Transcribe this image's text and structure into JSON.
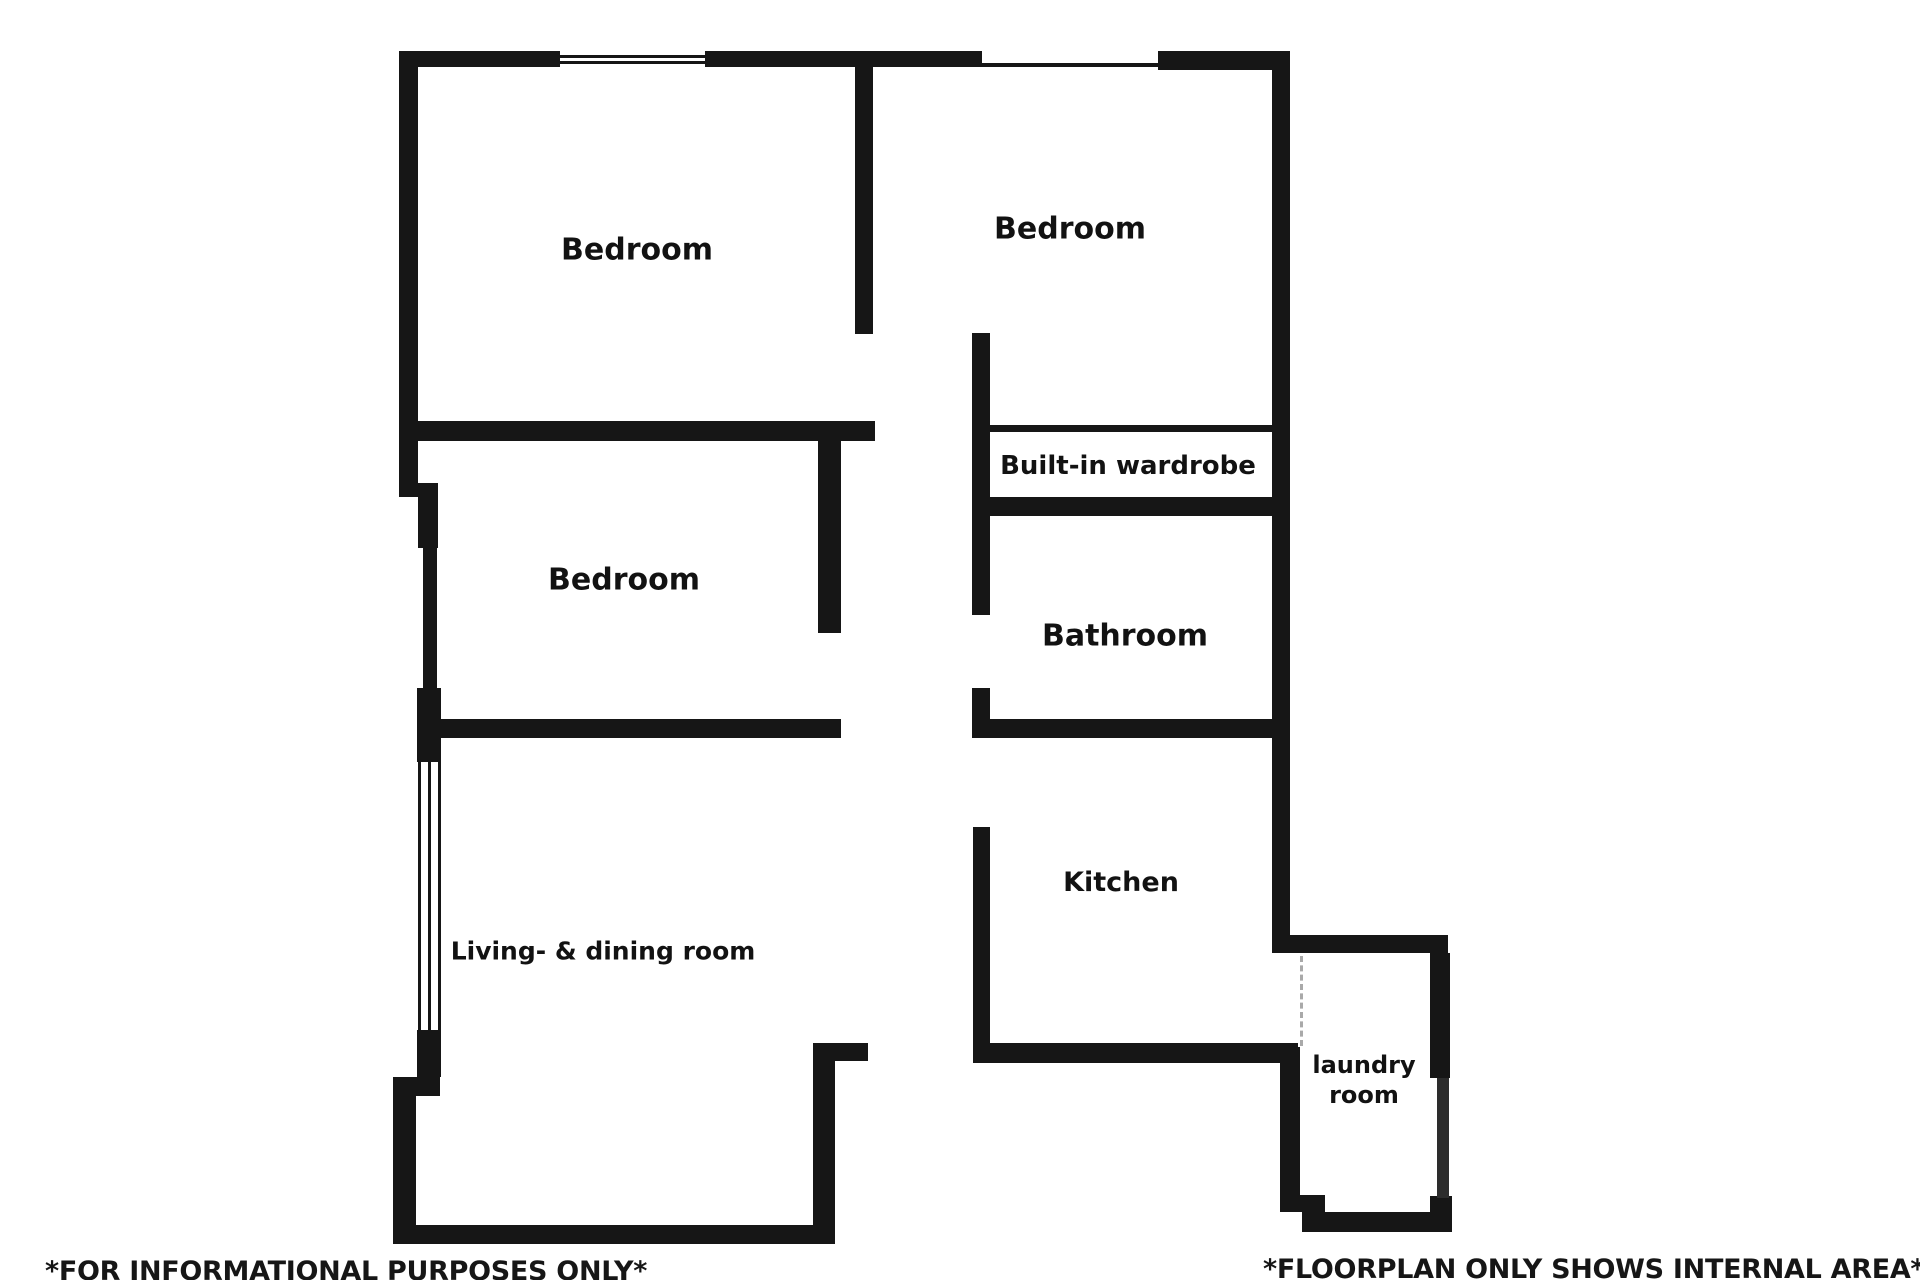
{
  "page": {
    "width": 1920,
    "height": 1280,
    "background": "#ffffff"
  },
  "colors": {
    "wall": "#161616",
    "text": "#121212",
    "window_line": "#161616",
    "dashed_opening": "#a9a9a9"
  },
  "floorplan": {
    "rooms": [
      {
        "name": "room-label-bedroom-top-left",
        "label": "Bedroom",
        "x": 637,
        "y": 250,
        "size": 30
      },
      {
        "name": "room-label-bedroom-top-right",
        "label": "Bedroom",
        "x": 1070,
        "y": 229,
        "size": 30
      },
      {
        "name": "room-label-bedroom-middle",
        "label": "Bedroom",
        "x": 624,
        "y": 580,
        "size": 30
      },
      {
        "name": "room-label-built-in-wardrobe",
        "label": "Built-in wardrobe",
        "x": 1128,
        "y": 466,
        "size": 26
      },
      {
        "name": "room-label-bathroom",
        "label": "Bathroom",
        "x": 1125,
        "y": 636,
        "size": 30
      },
      {
        "name": "room-label-kitchen",
        "label": "Kitchen",
        "x": 1121,
        "y": 883,
        "size": 27
      },
      {
        "name": "room-label-living-dining",
        "label": "Living- & dining room",
        "x": 603,
        "y": 951,
        "size": 25
      },
      {
        "name": "room-label-laundry",
        "label": "laundry\nroom",
        "x": 1364,
        "y": 1080,
        "size": 24
      }
    ],
    "captions": {
      "left": {
        "text": "*FOR INFORMATIONAL PURPOSES ONLY*",
        "x": 45,
        "y": 1257
      },
      "right": {
        "text": "*FLOORPLAN ONLY SHOWS INTERNAL AREA*",
        "x": 1263,
        "y": 1255
      }
    },
    "walls": [
      {
        "name": "top-wall",
        "x": 399,
        "y": 51,
        "w": 891,
        "h": 16
      },
      {
        "name": "top-right-corner-block",
        "x": 1158,
        "y": 51,
        "w": 132,
        "h": 19
      },
      {
        "name": "left-wall-upper",
        "x": 399,
        "y": 51,
        "w": 19,
        "h": 446
      },
      {
        "name": "left-step-block",
        "x": 418,
        "y": 483,
        "w": 20,
        "h": 65
      },
      {
        "name": "left-wall-middle-thin",
        "x": 423,
        "y": 548,
        "w": 14,
        "h": 141
      },
      {
        "name": "left-junction-block",
        "x": 417,
        "y": 688,
        "w": 24,
        "h": 74
      },
      {
        "name": "left-window-lower-block",
        "x": 417,
        "y": 1030,
        "w": 24,
        "h": 47
      },
      {
        "name": "left-step-bar",
        "x": 393,
        "y": 1077,
        "w": 47,
        "h": 19
      },
      {
        "name": "left-wall-lower",
        "x": 393,
        "y": 1096,
        "w": 23,
        "h": 147
      },
      {
        "name": "living-bottom-wall",
        "x": 393,
        "y": 1225,
        "w": 442,
        "h": 19
      },
      {
        "name": "living-right-wall",
        "x": 813,
        "y": 1043,
        "w": 22,
        "h": 201
      },
      {
        "name": "living-right-stub",
        "x": 835,
        "y": 1043,
        "w": 33,
        "h": 18
      },
      {
        "name": "top-bedrooms-divider-wall",
        "x": 855,
        "y": 51,
        "w": 18,
        "h": 283
      },
      {
        "name": "left-bedrooms-divider-wall",
        "x": 415,
        "y": 421,
        "w": 460,
        "h": 20
      },
      {
        "name": "middle-bedroom-right-wall",
        "x": 818,
        "y": 441,
        "w": 23,
        "h": 192
      },
      {
        "name": "living-top-wall",
        "x": 417,
        "y": 719,
        "w": 424,
        "h": 19
      },
      {
        "name": "wardrobe-left-wall",
        "x": 972,
        "y": 333,
        "w": 18,
        "h": 282
      },
      {
        "name": "bathroom-door-stub",
        "x": 972,
        "y": 688,
        "w": 18,
        "h": 50
      },
      {
        "name": "bathroom-bottom-wall",
        "x": 972,
        "y": 719,
        "w": 318,
        "h": 19
      },
      {
        "name": "wardrobe-front-line",
        "x": 990,
        "y": 425,
        "w": 282,
        "h": 7
      },
      {
        "name": "wardrobe-bottom-wall",
        "x": 972,
        "y": 497,
        "w": 300,
        "h": 19
      },
      {
        "name": "right-wall-main",
        "x": 1272,
        "y": 51,
        "w": 18,
        "h": 902
      },
      {
        "name": "laundry-top-wall",
        "x": 1290,
        "y": 935,
        "w": 158,
        "h": 18
      },
      {
        "name": "laundry-right-wall-upper",
        "x": 1430,
        "y": 953,
        "w": 20,
        "h": 125
      },
      {
        "name": "laundry-right-wall-corner",
        "x": 1430,
        "y": 1196,
        "w": 22,
        "h": 36
      },
      {
        "name": "laundry-bottom-wall",
        "x": 1302,
        "y": 1212,
        "w": 148,
        "h": 20
      },
      {
        "name": "laundry-left-wall",
        "x": 1280,
        "y": 1047,
        "w": 20,
        "h": 165
      },
      {
        "name": "laundry-step-block",
        "x": 1295,
        "y": 1195,
        "w": 30,
        "h": 17
      },
      {
        "name": "kitchen-bottom-wall",
        "x": 973,
        "y": 1043,
        "w": 325,
        "h": 20
      },
      {
        "name": "kitchen-left-wall",
        "x": 973,
        "y": 827,
        "w": 17,
        "h": 236
      }
    ],
    "window_parts": [
      {
        "name": "window-top-left-bg",
        "kind": "window-bg",
        "x": 560,
        "y": 51,
        "w": 145,
        "h": 16
      },
      {
        "name": "window-top-left-line-a",
        "kind": "window-line",
        "x": 560,
        "y": 55,
        "w": 145,
        "h": 3
      },
      {
        "name": "window-top-left-line-b",
        "kind": "window-line",
        "x": 560,
        "y": 61,
        "w": 145,
        "h": 3
      },
      {
        "name": "window-top-right-bg",
        "kind": "window-bg",
        "x": 982,
        "y": 51,
        "w": 176,
        "h": 12
      },
      {
        "name": "window-living-line-left",
        "kind": "window-line",
        "x": 418,
        "y": 762,
        "w": 3,
        "h": 268
      },
      {
        "name": "window-living-line-mid",
        "kind": "window-line",
        "x": 428,
        "y": 762,
        "w": 3,
        "h": 268
      },
      {
        "name": "window-living-line-right",
        "kind": "window-line",
        "x": 438,
        "y": 762,
        "w": 3,
        "h": 268
      },
      {
        "name": "window-laundry-bar",
        "kind": "window-bar",
        "x": 1437,
        "y": 1078,
        "w": 12,
        "h": 120
      }
    ],
    "dashed_openings": [
      {
        "name": "kitchen-laundry-opening-dash",
        "x": 1300,
        "y": 956,
        "h": 90
      }
    ]
  }
}
